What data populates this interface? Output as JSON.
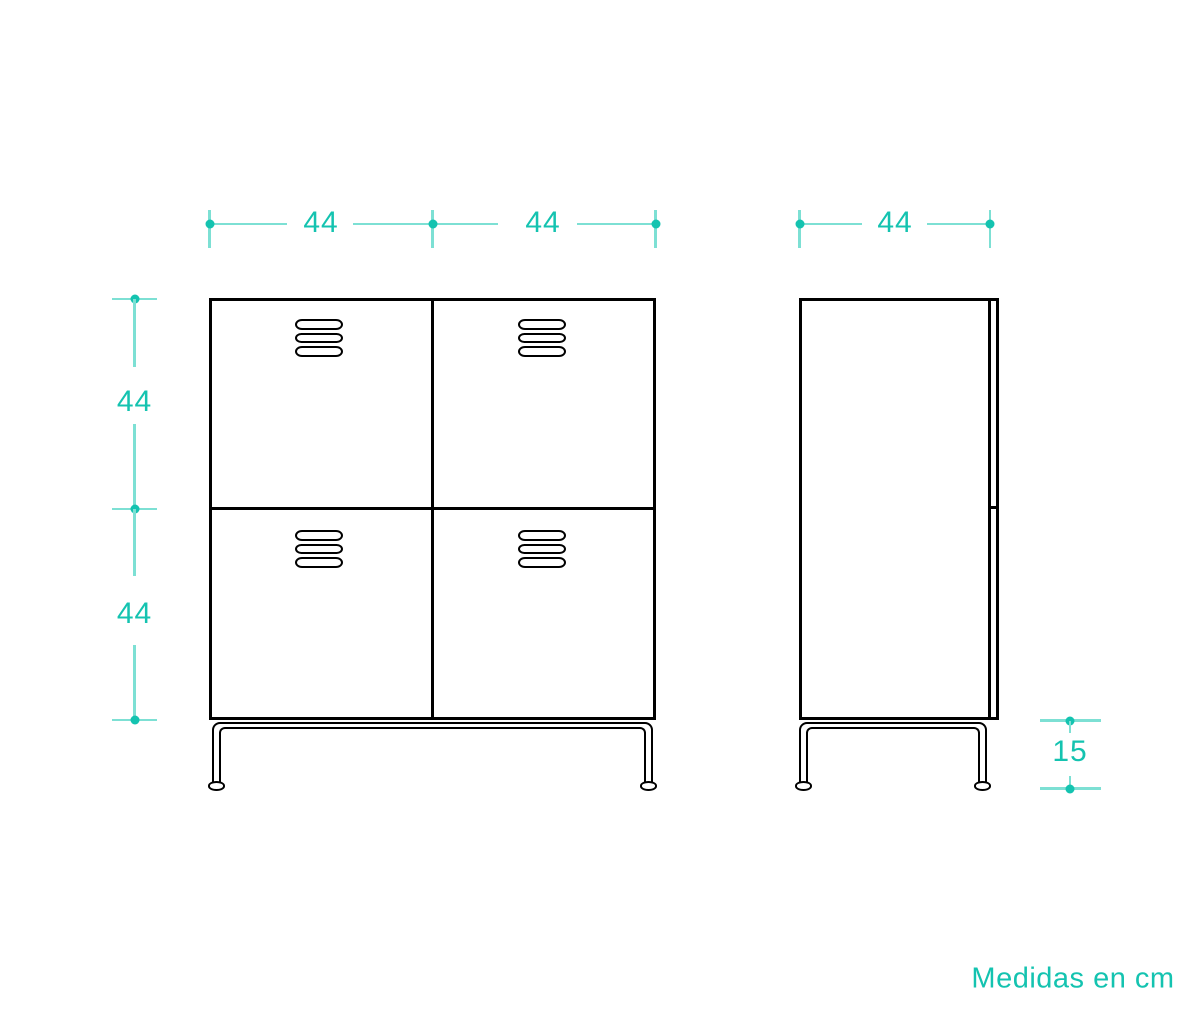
{
  "diagram": {
    "units_note": "Medidas en cm",
    "colors": {
      "accent": "#14c3b0",
      "accent_light": "#7de0d4",
      "stroke": "#000000"
    },
    "dimensions": {
      "front_width_left": "44",
      "front_width_right": "44",
      "side_depth": "44",
      "front_height_upper": "44",
      "front_height_lower": "44",
      "leg_height": "15"
    }
  }
}
